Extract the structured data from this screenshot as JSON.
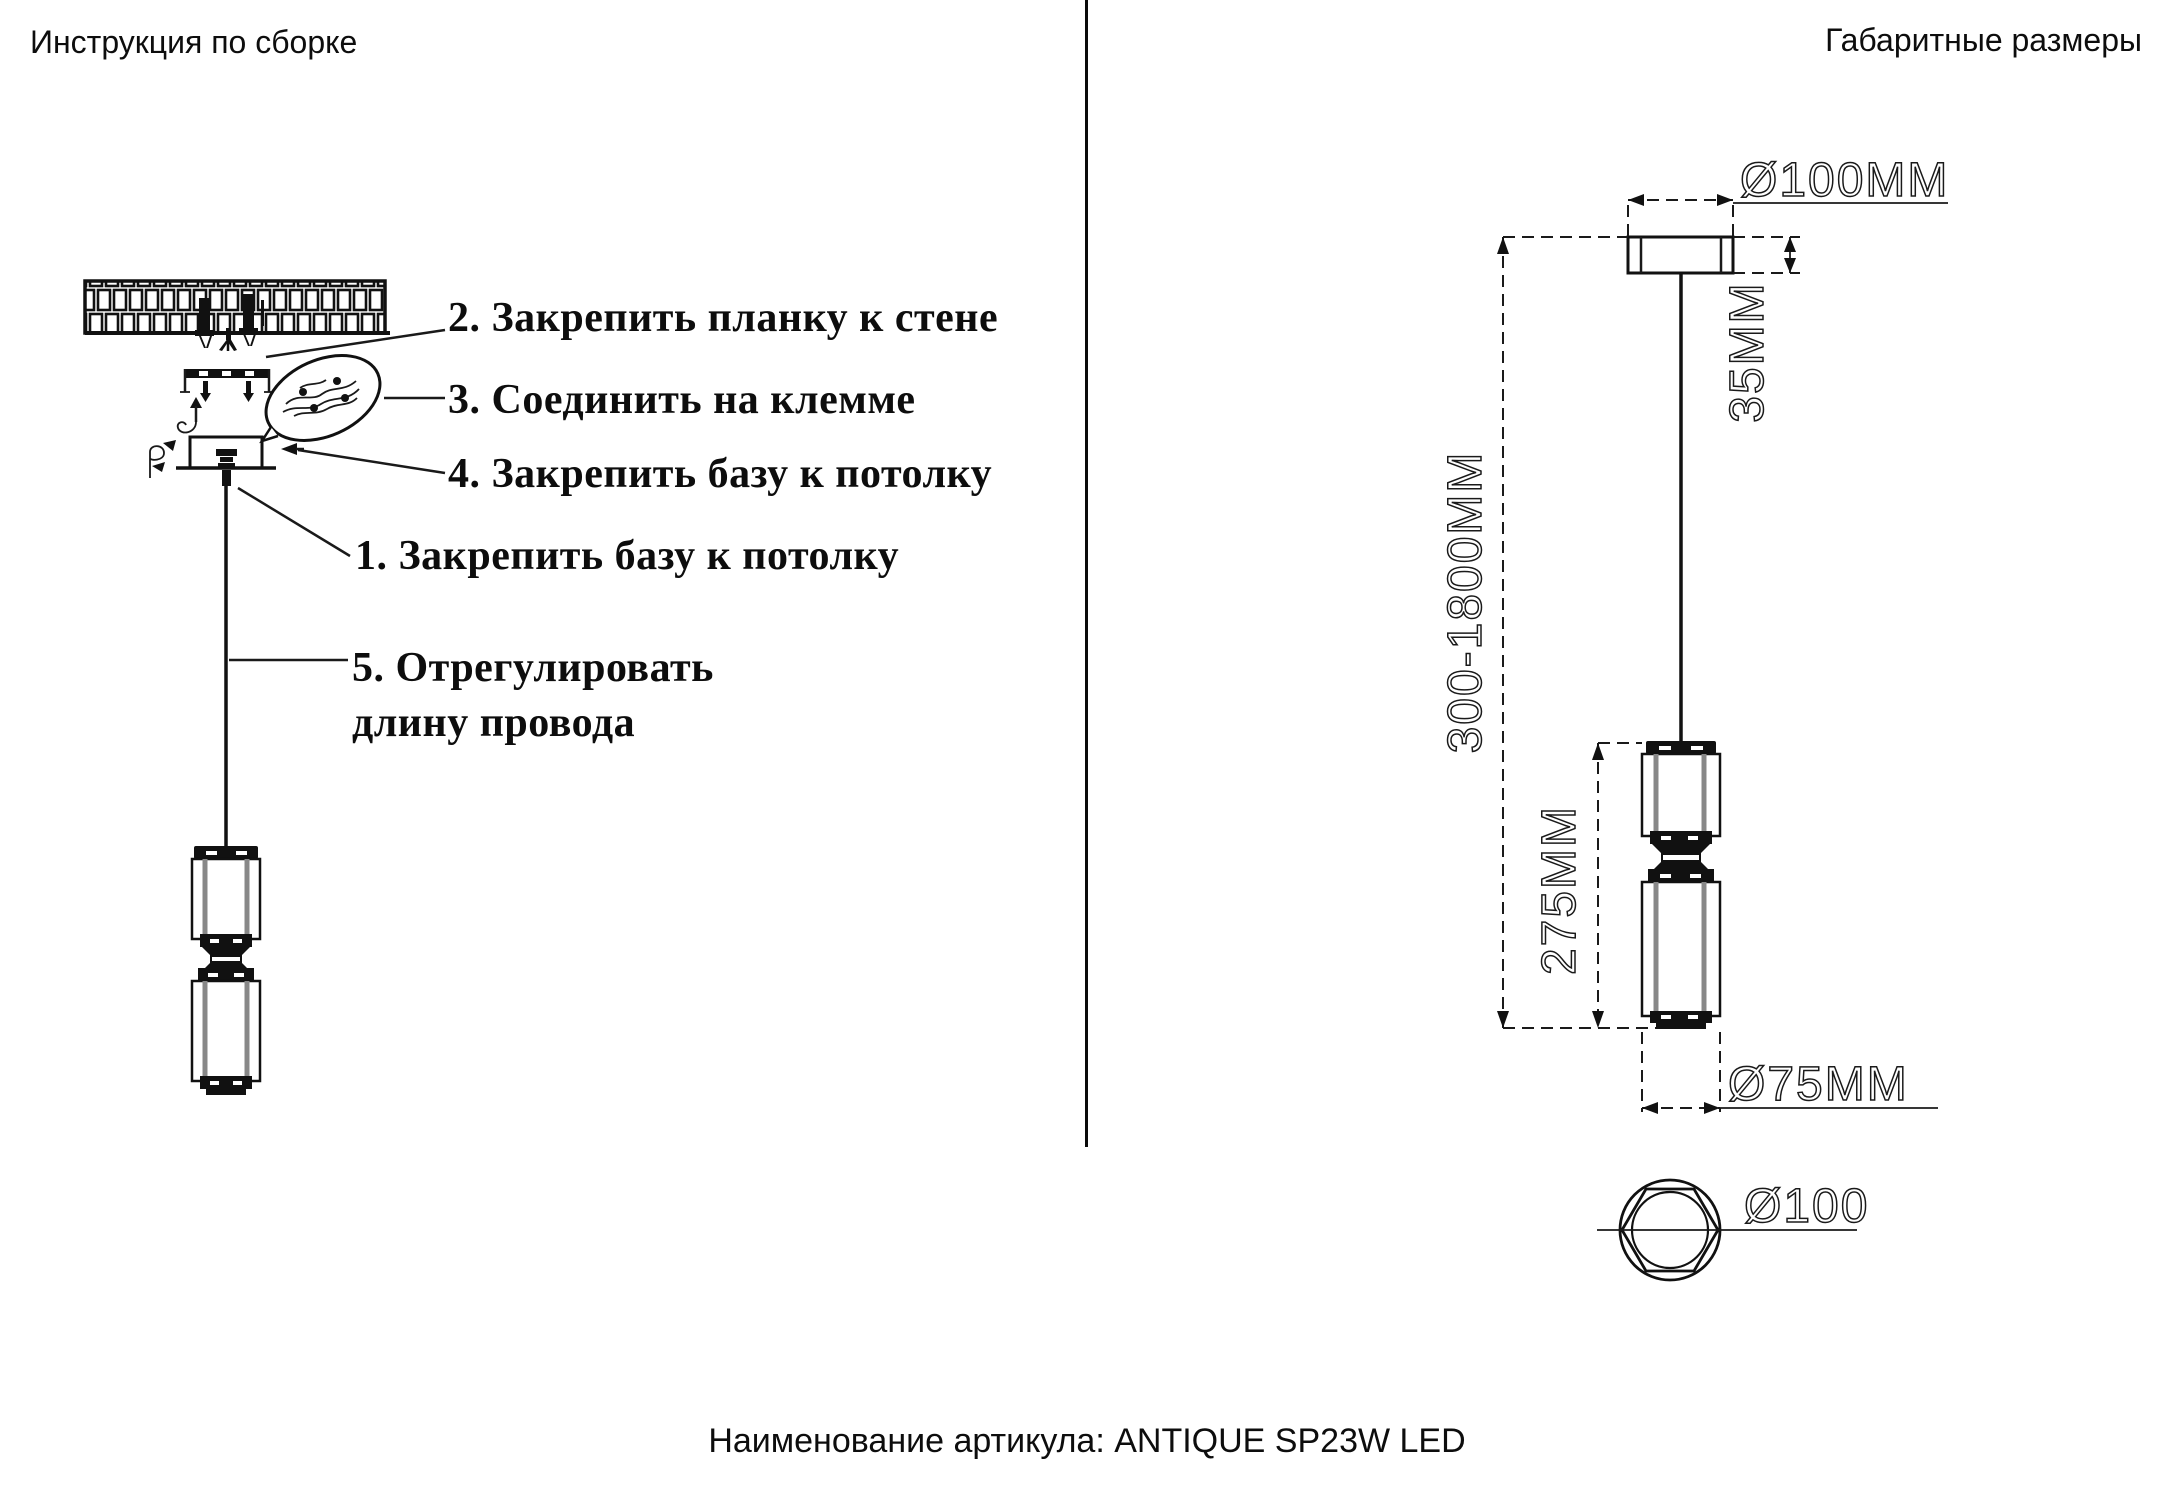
{
  "left_section": {
    "title": "Инструкция по сборке",
    "steps": {
      "s2": "2. Закрепить планку к стене",
      "s3": "3. Соединить на клемме",
      "s4": "4. Закрепить базу к потолку",
      "s1": "1. Закрепить базу к потолку",
      "s5_line1": "5. Отрегулировать",
      "s5_line2": "длину провода"
    }
  },
  "right_section": {
    "title": "Габаритные размеры",
    "dims": {
      "canopy_diameter": "Ø100MM",
      "canopy_height": "35MM",
      "suspension_range": "300-1800MM",
      "shade_height": "275MM",
      "shade_diameter": "Ø75MM",
      "top_view_diameter": "Ø100"
    }
  },
  "footer": {
    "caption": "Наименование артикула: ANTIQUE SP23W LED"
  },
  "colors": {
    "ink": "#1a1a1a",
    "background": "#ffffff"
  }
}
